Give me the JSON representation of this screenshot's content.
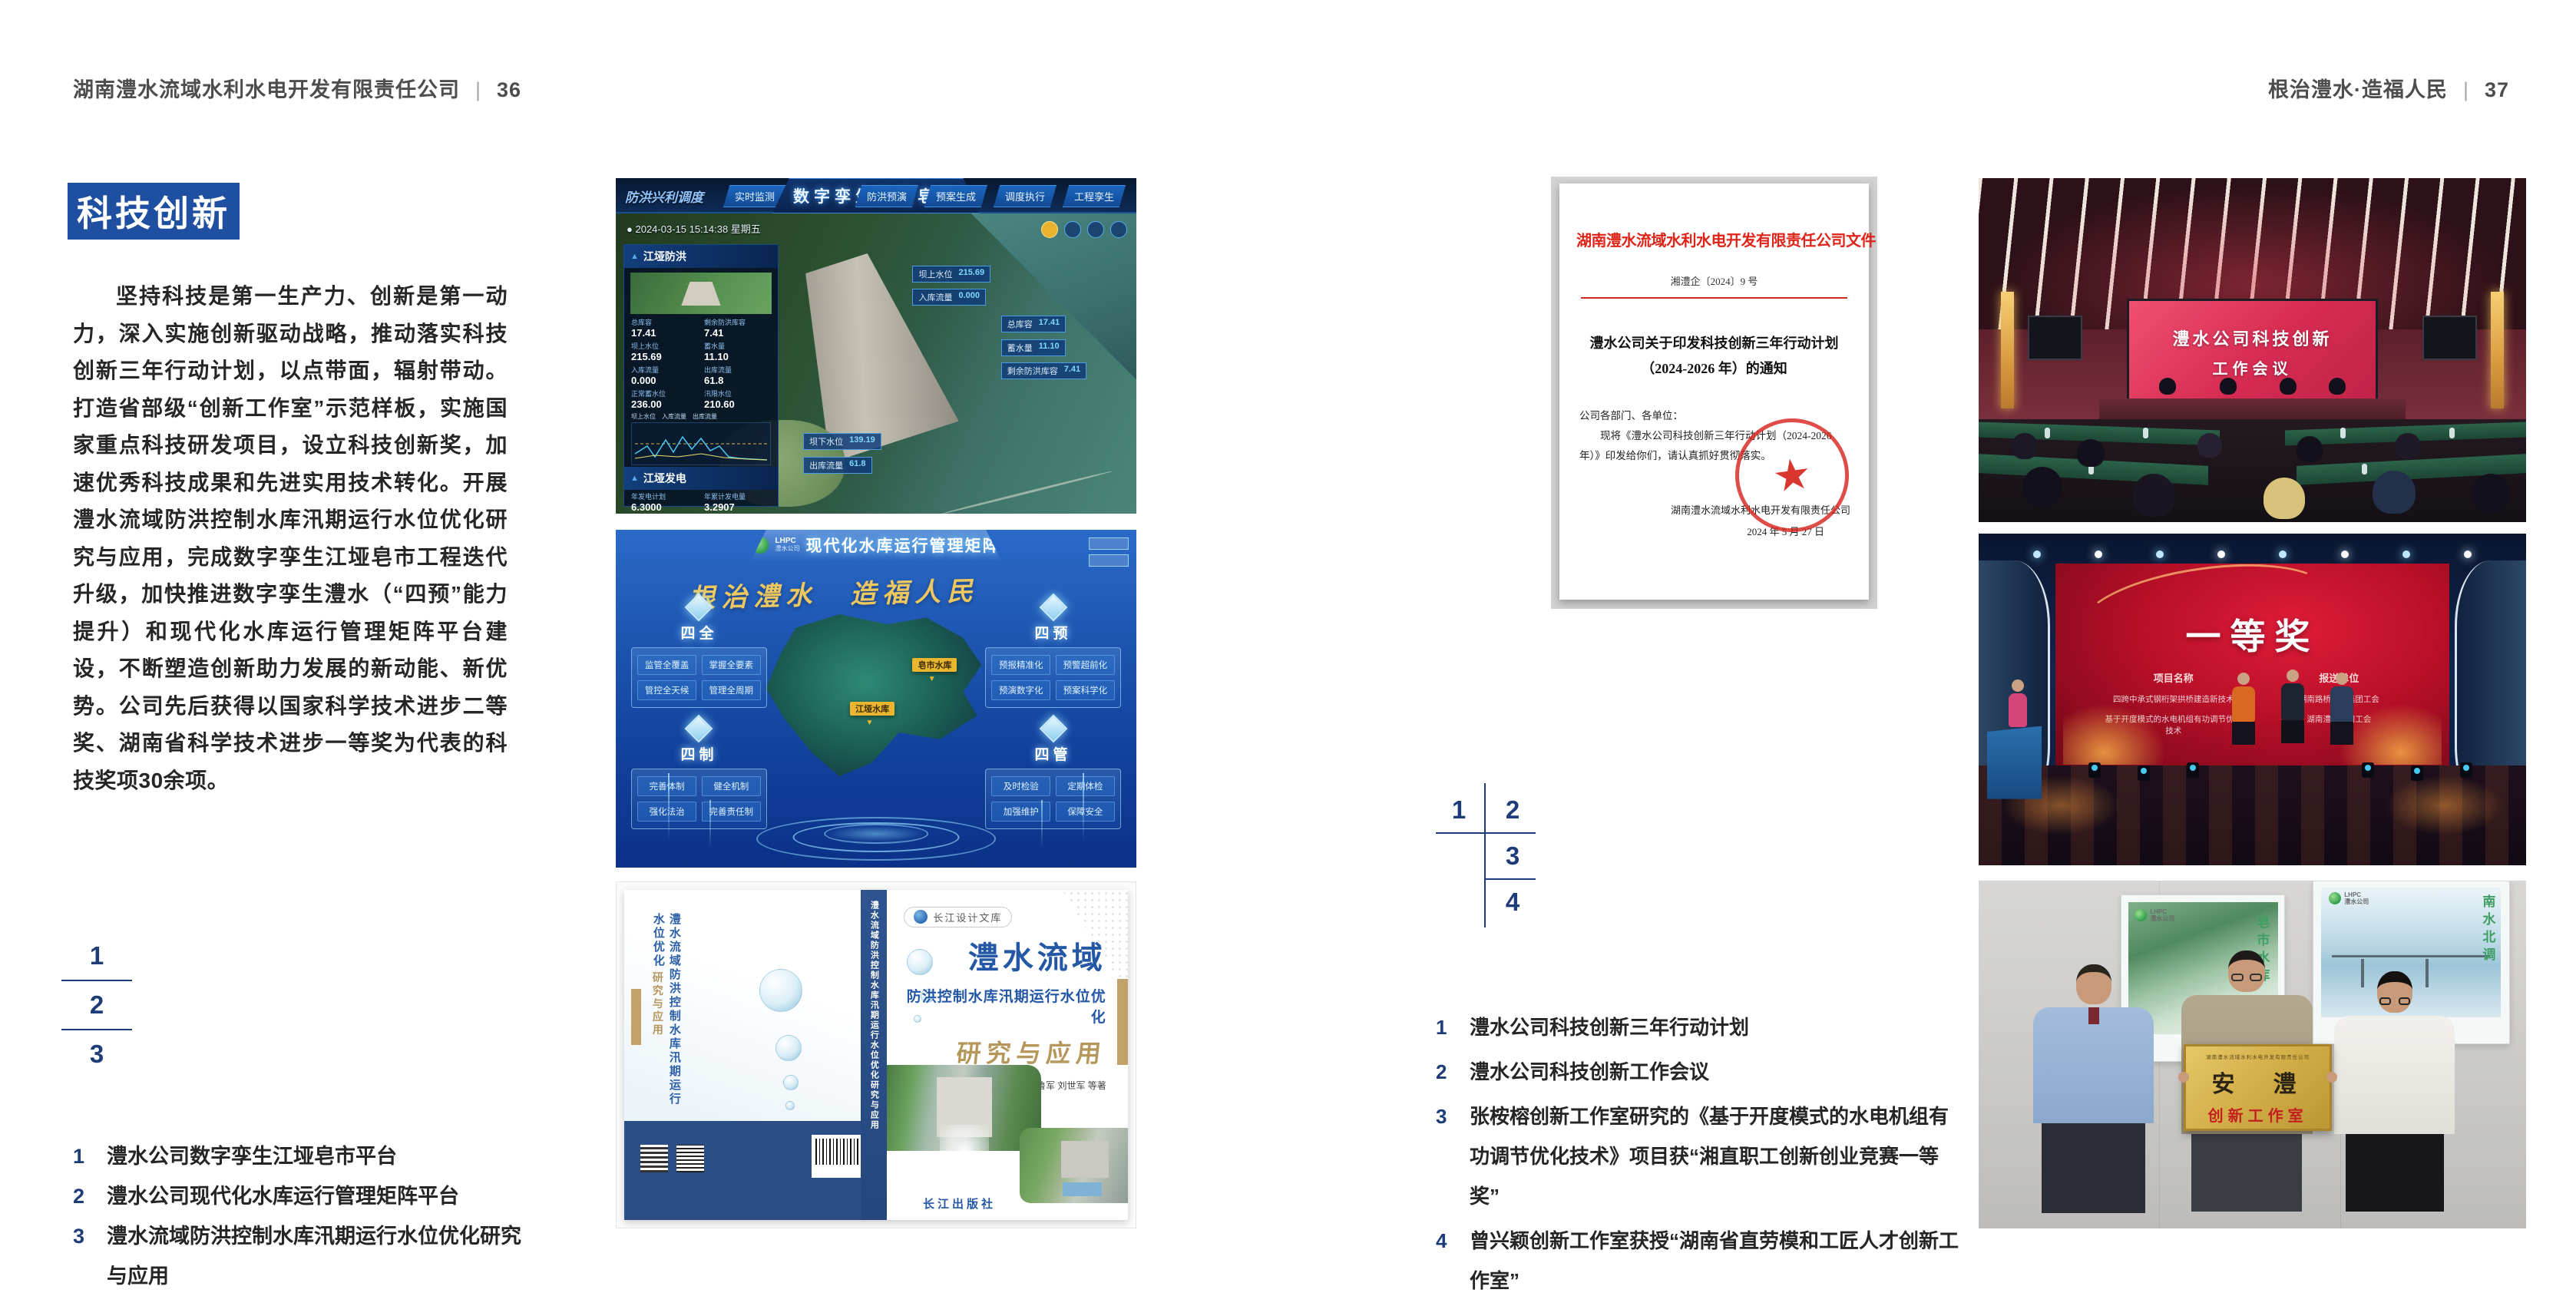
{
  "colors": {
    "accent_blue": "#1f4fa0",
    "figure_number_navy": "#1d3c78",
    "document_red": "#d8261d",
    "award_screen_red": "#c4122a",
    "plaque_gold": "#c9a63e",
    "dashboard_blue": "#1b52ad"
  },
  "icons": {
    "star": "★",
    "triangle": "▲",
    "pin": "▼",
    "dot": "●"
  },
  "headers": {
    "left": {
      "company": "湖南澧水流域水利水电开发有限责任公司",
      "sep": "|",
      "page": "36"
    },
    "right": {
      "slogan": "根治澧水·造福人民",
      "sep": "|",
      "page": "37"
    }
  },
  "left_page": {
    "section_title": "科技创新",
    "paragraph": "坚持科技是第一生产力、创新是第一动力，深入实施创新驱动战略，推动落实科技创新三年行动计划，以点带面，辐射带动。打造省部级“创新工作室”示范样板，实施国家重点科技研发项目，设立科技创新奖，加速优秀科技成果和先进实用技术转化。开展澧水流域防洪控制水库汛期运行水位优化研究与应用，完成数字孪生江垭皂市工程迭代升级，加快推进数字孪生澧水（“四预”能力提升）和现代化水库运行管理矩阵平台建设，不断塑造创新助力发展的新动能、新优势。公司先后获得以国家科学技术进步二等奖、湖南省科学技术进步一等奖为代表的科技奖项30余项。",
    "fig_nums": [
      "1",
      "2",
      "3"
    ],
    "captions": [
      {
        "num": "1",
        "text": "澧水公司数字孪生江垭皂市平台"
      },
      {
        "num": "2",
        "text": "澧水公司现代化水库运行管理矩阵平台"
      },
      {
        "num": "3",
        "text": "澧水流域防洪控制水库汛期运行水位优化研究与应用"
      }
    ]
  },
  "twin_dashboard": {
    "mode_label": "防洪兴利调度",
    "title": "数字孪生江垭皂市",
    "tabs_left": [
      "实时监测",
      "洪水预报",
      "防洪预警"
    ],
    "tabs_right": [
      "防洪预演",
      "预案生成",
      "调度执行",
      "工程孪生"
    ],
    "timestamp": "2024-03-15 15:14:38 星期五",
    "flood_panel": {
      "title": "江垭防洪",
      "stats": [
        {
          "label": "总库容",
          "value": "17.41"
        },
        {
          "label": "剩余防洪库容",
          "value": "7.41"
        },
        {
          "label": "坝上水位",
          "value": "215.69"
        },
        {
          "label": "蓄水量",
          "value": "11.10"
        },
        {
          "label": "入库流量",
          "value": "0.000"
        },
        {
          "label": "出库流量",
          "value": "61.8"
        },
        {
          "label": "正常蓄水位",
          "value": "236.00"
        },
        {
          "label": "汛限水位",
          "value": "210.60"
        }
      ]
    },
    "legend": [
      "坝上水位",
      "入库流量",
      "出库流量"
    ],
    "power_panel": {
      "title": "江垭发电",
      "stats": [
        {
          "label": "年发电计划",
          "value": "6.3000"
        },
        {
          "label": "年累计发电量",
          "value": "3.2907"
        },
        {
          "label": "月累计发电量",
          "value": "3259.21"
        },
        {
          "label": "当前出力",
          "value": "0.00"
        },
        {
          "label": "发电流量",
          "value": "0.00"
        },
        {
          "label": "弃水流量",
          "value": "0.00"
        }
      ]
    },
    "chips_upper": [
      {
        "label": "坝上水位",
        "value": "215.69"
      },
      {
        "label": "入库流量",
        "value": "0.000"
      }
    ],
    "chips_right": [
      {
        "label": "总库容",
        "value": "17.41"
      },
      {
        "label": "蓄水量",
        "value": "11.10"
      },
      {
        "label": "剩余防洪库容",
        "value": "7.41"
      }
    ],
    "chips_lower": [
      {
        "label": "坝下水位",
        "value": "139.19"
      },
      {
        "label": "出库流量",
        "value": "61.8"
      }
    ]
  },
  "matrix_dashboard": {
    "logo_text": "LHPC",
    "logo_sub": "澧水公司",
    "title": "现代化水库运行管理矩阵",
    "slogan": "根治澧水　造福人民",
    "groups": [
      {
        "title": "四全",
        "items": [
          "监管全覆盖",
          "掌握全要素",
          "管控全天候",
          "管理全周期"
        ]
      },
      {
        "title": "四预",
        "items": [
          "预报精准化",
          "预警超前化",
          "预演数字化",
          "预案科学化"
        ]
      },
      {
        "title": "四制",
        "items": [
          "完善体制",
          "健全机制",
          "强化法治",
          "完善责任制"
        ]
      },
      {
        "title": "四管",
        "items": [
          "及时检验",
          "定期体检",
          "加强维护",
          "保障安全"
        ]
      }
    ],
    "map_labels": [
      "皂市水库",
      "江垭水库"
    ]
  },
  "book": {
    "series": "长江设计文库",
    "title1": "澧水流域",
    "title2": "防洪控制水库汛期运行水位优化",
    "title3": "研究与应用",
    "authors": "洪兴骏  沈坤民  鲁军  刘世军  等著",
    "back_title": "澧水流域防洪控制水库汛期运行水位优化",
    "spine": "澧水流域防洪控制水库汛期运行水位优化研究与应用",
    "publisher": "长江出版社"
  },
  "official_document": {
    "header": "湖南澧水流域水利水电开发有限责任公司文件",
    "doc_number": "湘澧企〔2024〕9 号",
    "title_line1": "澧水公司关于印发科技创新三年行动计划",
    "title_line2": "（2024-2026 年）的通知",
    "salutation": "公司各部门、各单位：",
    "body": "现将《澧水公司科技创新三年行动计划（2024-2026 年）》印发给你们，请认真抓好贯彻落实。",
    "signature": "湖南澧水流域水利水电开发有限责任公司",
    "date": "2024 年 5 月 27 日"
  },
  "right_page": {
    "fig_nums": [
      "1",
      "2",
      "3",
      "4"
    ],
    "captions": [
      {
        "num": "1",
        "text": "澧水公司科技创新三年行动计划"
      },
      {
        "num": "2",
        "text": "澧水公司科技创新工作会议"
      },
      {
        "num": "3",
        "text": "张桉榕创新工作室研究的《基于开度模式的水电机组有功调节优化技术》项目获“湘直职工创新创业竞赛一等奖”"
      },
      {
        "num": "4",
        "text": "曾兴颖创新工作室获授“湖南省直劳模和工匠人才创新工作室”"
      }
    ]
  },
  "meeting_photo": {
    "screen_line1": "澧水公司科技创新",
    "screen_line2": "工作会议"
  },
  "award_photo": {
    "title": "一等奖",
    "col1_header": "项目名称",
    "col2_header": "报送单位",
    "rows": [
      {
        "project": "四跨中承式钢桁架拱桥建造新技术",
        "org": "湖南路桥建设集团工会"
      },
      {
        "project": "基于开度模式的水电机组有功调节优化技术",
        "org": "湖南澧水公司工会"
      }
    ]
  },
  "plaque_photo": {
    "org_line": "湖南澧水流域水利水电开发有限责任公司",
    "name": "安　澧",
    "subtitle": "创新工作室",
    "poster_left_text": "皂市水库",
    "poster_right_text": "南水北调",
    "logo_text": "LHPC",
    "logo_sub": "澧水公司"
  }
}
